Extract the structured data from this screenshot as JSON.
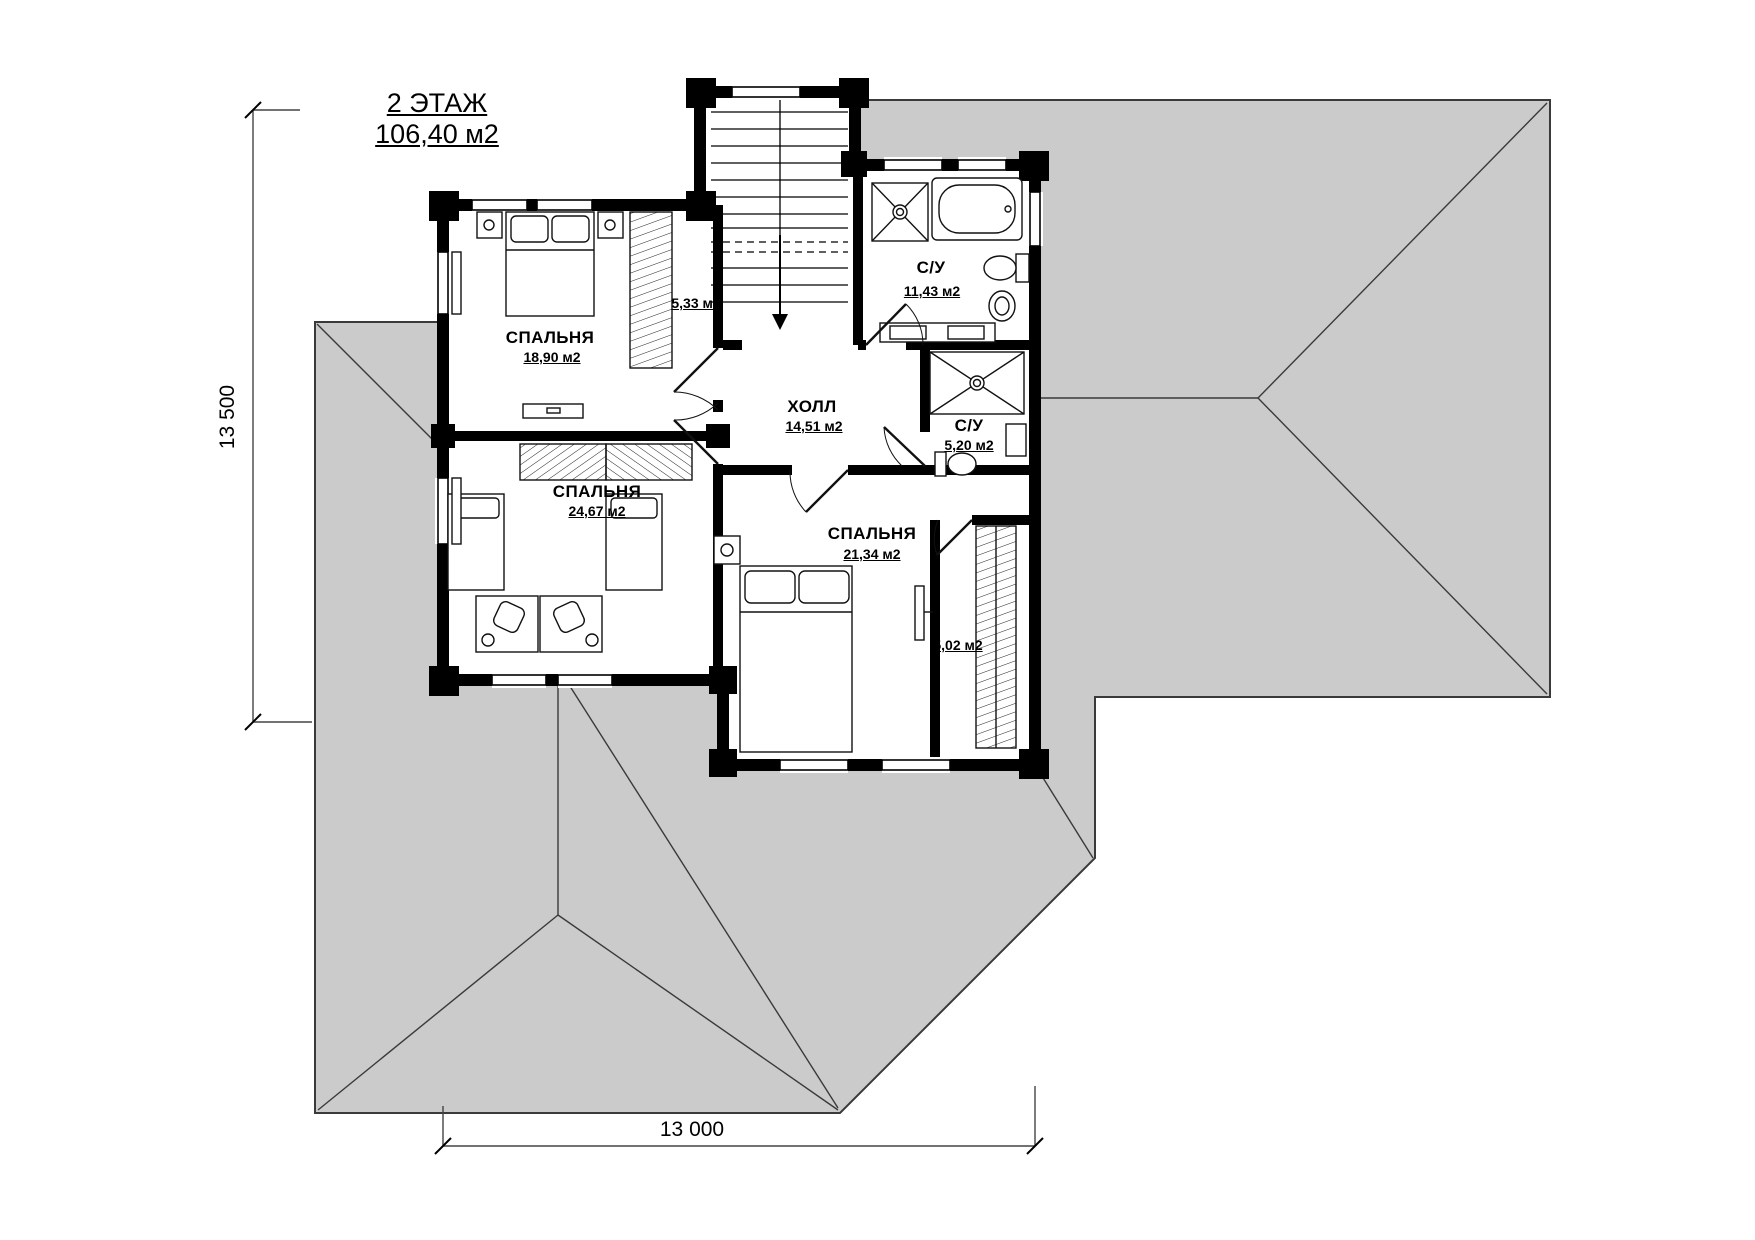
{
  "title": {
    "floor": "2 ЭТАЖ",
    "area": "106,40 м2"
  },
  "dimensions": {
    "vertical": "13 500",
    "horizontal": "13 000"
  },
  "rooms": [
    {
      "name": "СПАЛЬНЯ",
      "area": "18,90 м2"
    },
    {
      "name": "СПАЛЬНЯ",
      "area": "24,67 м2"
    },
    {
      "name": "СПАЛЬНЯ",
      "area": "21,34 м2"
    },
    {
      "name": "ХОЛЛ",
      "area": "14,51 м2"
    },
    {
      "name": "С/У",
      "area": "11,43 м2"
    },
    {
      "name": "С/У",
      "area": "5,20 м2"
    },
    {
      "name": "",
      "area": "5,33 м2"
    },
    {
      "name": "",
      "area": "5,02 м2"
    }
  ],
  "colors": {
    "roof": "#cbcbcb",
    "wall": "#000000",
    "line": "#3a3a3a"
  }
}
